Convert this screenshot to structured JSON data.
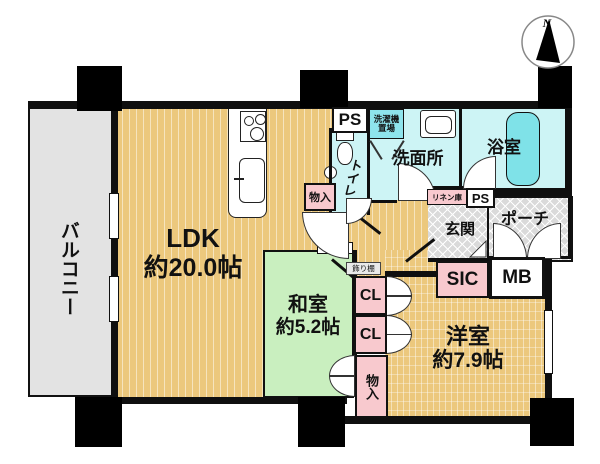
{
  "meta": {
    "type": "apartment-floor-plan"
  },
  "compass": {
    "north_label": "N"
  },
  "rooms": {
    "balcony": {
      "name": "バルコニー"
    },
    "ldk": {
      "name": "LDK",
      "area": "約20.0帖"
    },
    "washitsu": {
      "name": "和室",
      "area": "約5.2帖"
    },
    "youshitsu": {
      "name": "洋室",
      "area": "約7.9帖"
    },
    "toilet": {
      "name": "トイレ"
    },
    "washroom": {
      "name": "洗面所"
    },
    "bathroom": {
      "name": "浴室"
    },
    "laundry": {
      "name_line1": "洗濯機",
      "name_line2": "置場"
    },
    "genkan": {
      "name": "玄関"
    },
    "porch": {
      "name": "ポーチ"
    }
  },
  "storage": {
    "ps_top": {
      "label": "PS"
    },
    "ps_mid": {
      "label": "PS"
    },
    "linen": {
      "label": "リネン庫"
    },
    "hall_storage": {
      "label": "物入"
    },
    "south_storage": {
      "label": "物入"
    },
    "cl_upper": {
      "label": "CL"
    },
    "cl_lower": {
      "label": "CL"
    },
    "sic": {
      "label": "SIC"
    },
    "mb": {
      "label": "MB"
    },
    "kazaridana": {
      "label": "飾り棚"
    }
  },
  "colors": {
    "flooring": "#ecc87d",
    "tatami_green": "#c9efbf",
    "wet_cyan": "#cdf4f5",
    "bathtub_cyan": "#7fe2e8",
    "storage_pink": "#f8c9ce",
    "balcony_gray": "#e3e3e3",
    "tile_gray": "#dadada",
    "wall_black": "#0f0f0f"
  }
}
